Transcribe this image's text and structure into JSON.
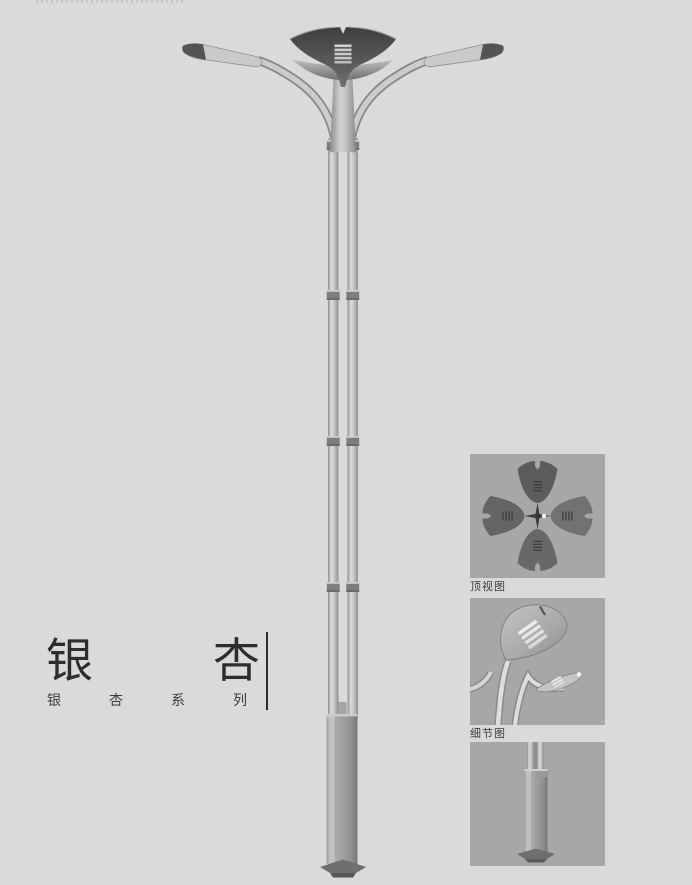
{
  "page": {
    "type": "street-lamp-catalog-page",
    "background_color": "#dadada"
  },
  "title_block": {
    "title": "银杏",
    "subtitle": "银杏系列"
  },
  "thumbnails": [
    {
      "name": "top-view",
      "caption": "顶视图"
    },
    {
      "name": "detail-view",
      "caption": "细节图"
    },
    {
      "name": "base-view"
    }
  ],
  "illustration": {
    "name": "ginkgo-double-arm-street-lamp",
    "parts": [
      "ginkgo-leaf-crown",
      "left-lamp-arm",
      "right-lamp-arm",
      "twin-tube-pole",
      "pole-joint-bands",
      "square-base-column",
      "base-plate"
    ]
  },
  "colors": {
    "page_background": "#dadada",
    "thumbnail_background": "#a7a7a7",
    "lamp_dark_gray": "#4a4a4a",
    "lamp_metal_light": "#c9c9c9",
    "base_column_gray": "#9a9a9a",
    "text_color": "#2d2d2d"
  }
}
